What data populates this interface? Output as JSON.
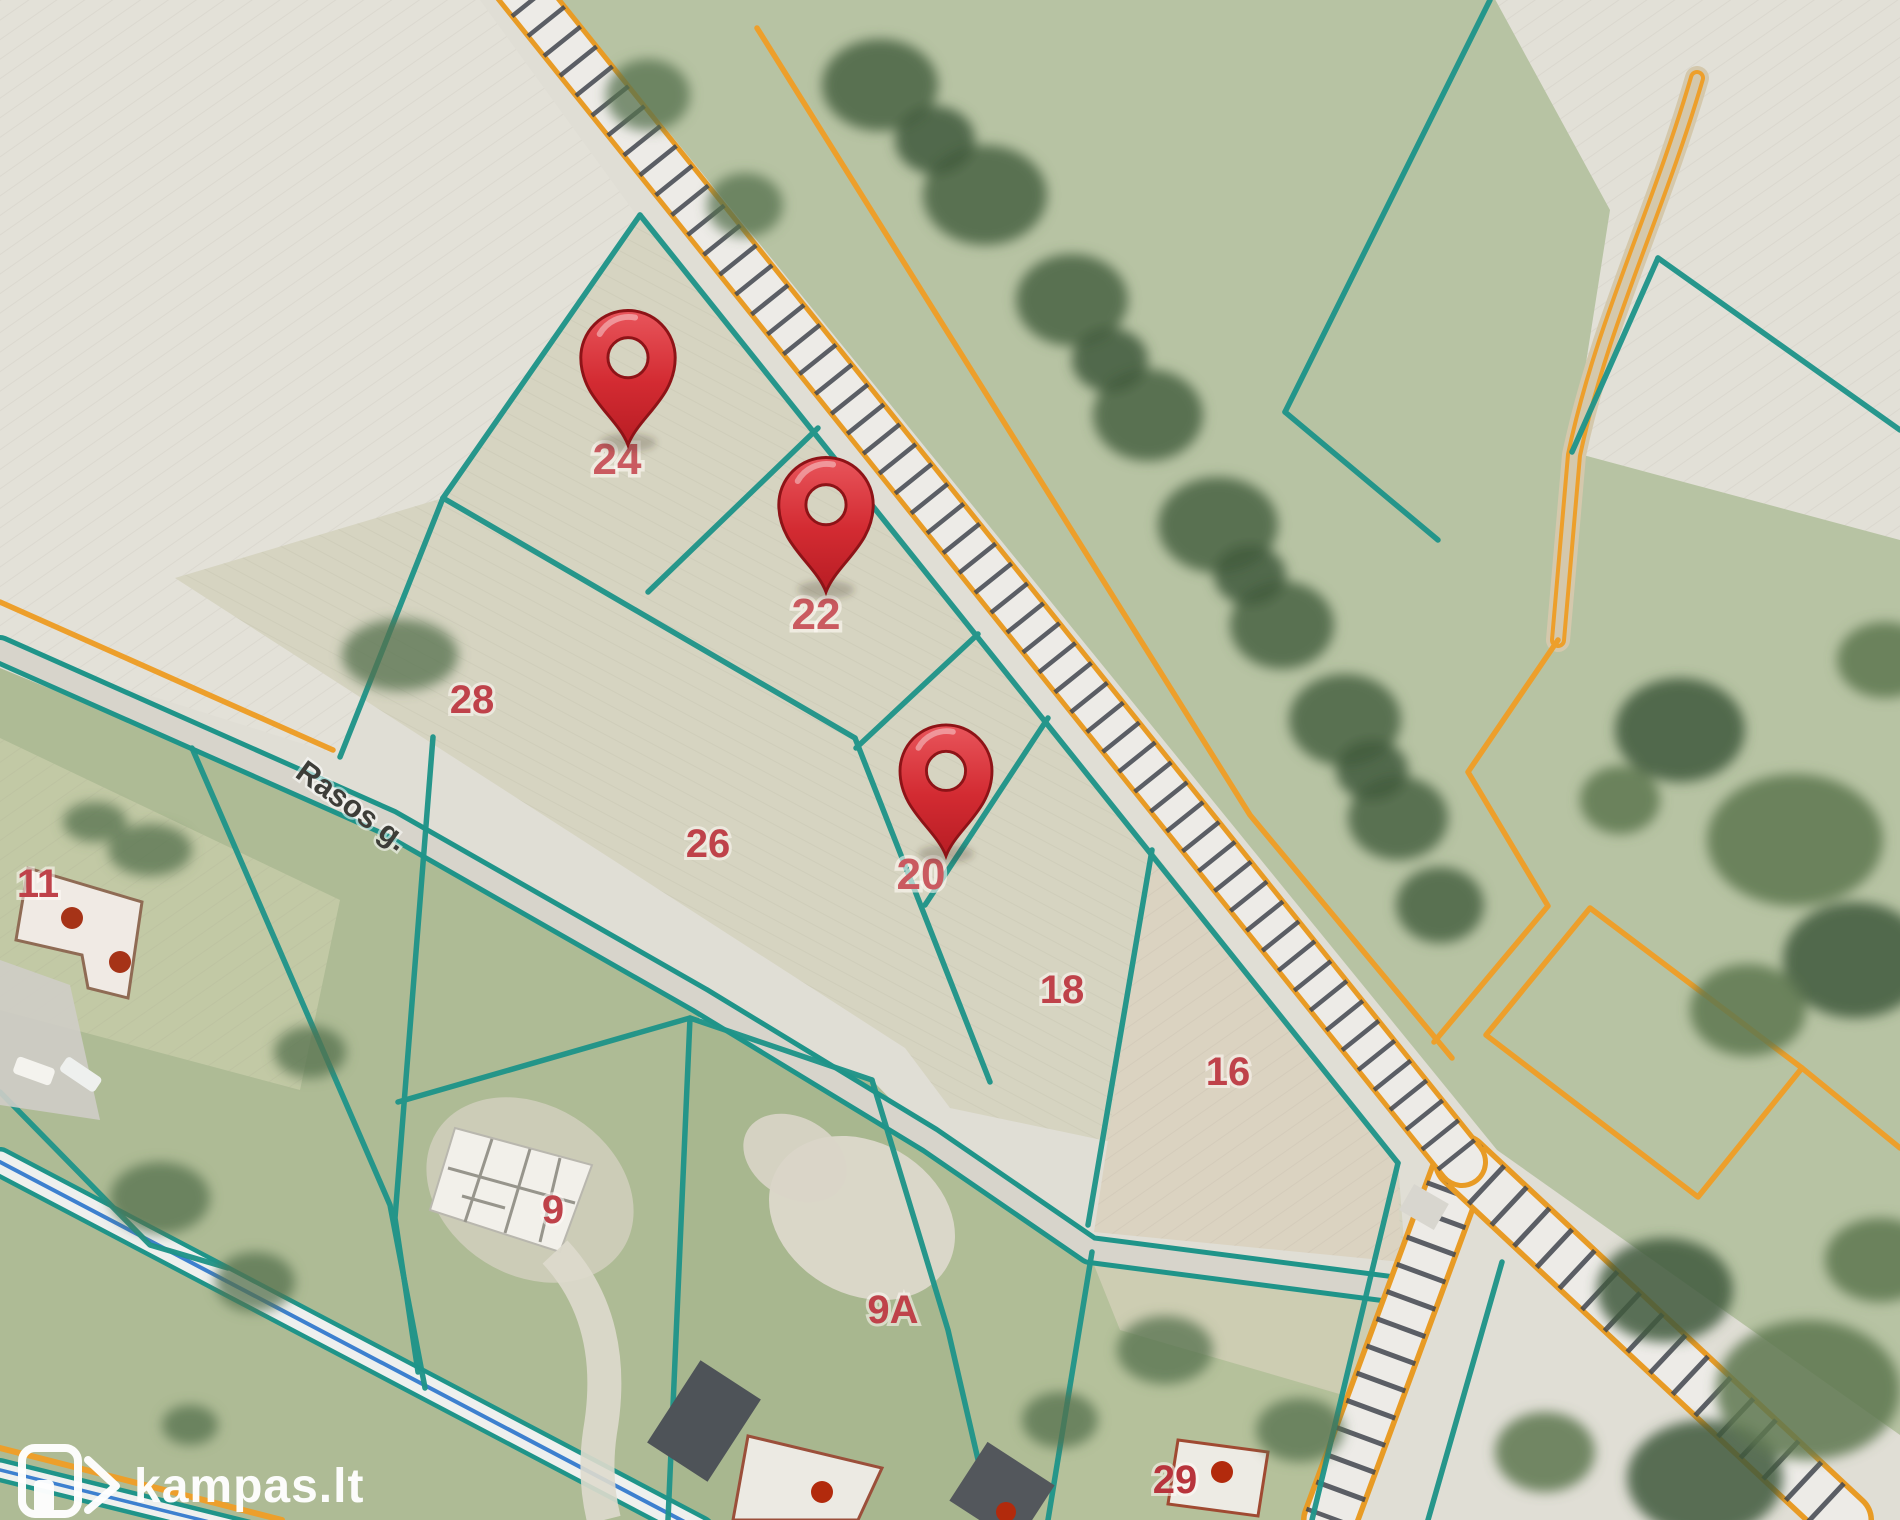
{
  "map": {
    "street_label": "Rasos g.",
    "parcel_labels": [
      {
        "number": "24"
      },
      {
        "number": "22"
      },
      {
        "number": "20"
      },
      {
        "number": "28"
      },
      {
        "number": "26"
      },
      {
        "number": "18"
      },
      {
        "number": "16"
      },
      {
        "number": "11"
      },
      {
        "number": "9"
      },
      {
        "number": "9A"
      },
      {
        "number": "29"
      }
    ],
    "pins": [
      {
        "parcel": "24"
      },
      {
        "parcel": "22"
      },
      {
        "parcel": "20"
      }
    ],
    "colors": {
      "boundary_teal": "#1f9489",
      "utility_orange": "#ed9f2b",
      "pin_red": "#c8232b",
      "parcel_number_red": "#bf424a",
      "road_blue": "#3d80cf",
      "field_pale": "#e0ded5",
      "grass_green": "#aebb95"
    }
  },
  "watermark": {
    "logo_text": "kampas.lt"
  }
}
